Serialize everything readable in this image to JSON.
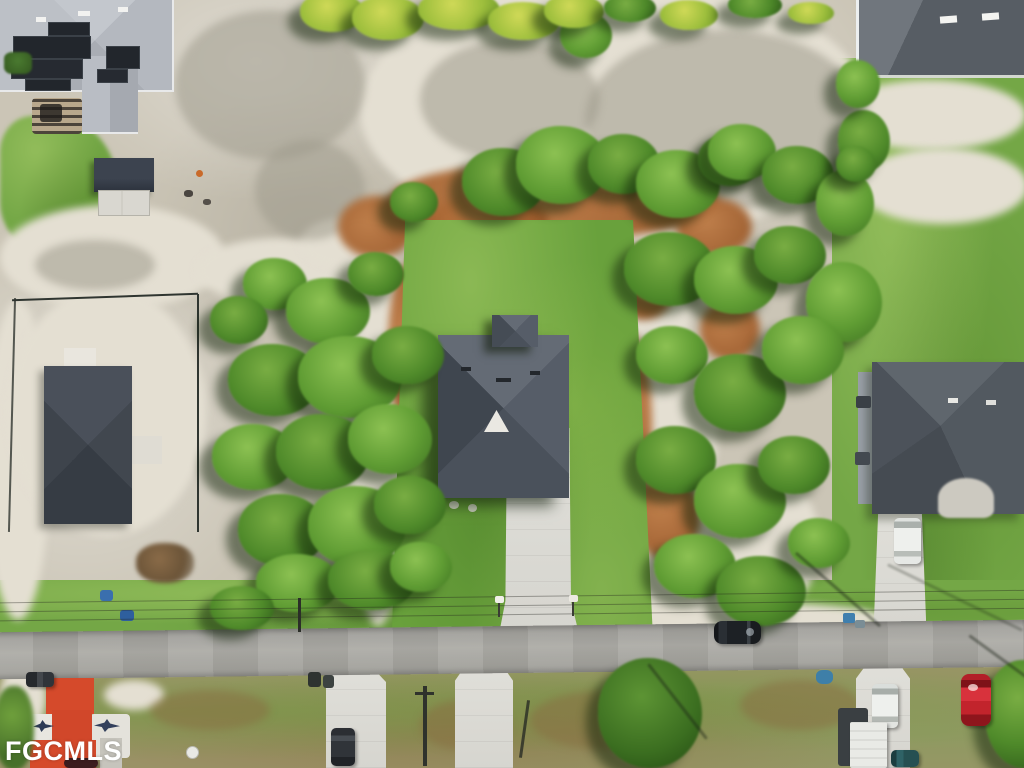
{
  "watermark": {
    "text": "FGCMLS",
    "color": "#ffffff"
  },
  "scene": {
    "description": "Aerial drone photo of a residential neighborhood: new home with gray hip roof and concrete driveway on a green lawn lot, surrounded by trees, white sand, brown mulch, neighboring houses and a street with parked cars",
    "palette": {
      "sand": "#cbc5b6",
      "sand_bright": "#e4dfd2",
      "lawn": "#69a13c",
      "grass": "#74a746",
      "tree": "#4f8a2a",
      "tree_dark": "#234a12",
      "mulch": "#a2602f",
      "road": "#a3a29e",
      "concrete": "#dcdbd5",
      "roof_slate": "#4a515b",
      "roof_light": "#b9bdc3",
      "solar_panel": "#22262c",
      "red_roof": "#d54a2b"
    }
  },
  "objects": {
    "main_house_label": "main house with driveway",
    "cars": [
      {
        "label": "black car parked on road",
        "color": "#1d2125"
      },
      {
        "label": "dark pickup at left road edge",
        "color": "#3b3e42"
      },
      {
        "label": "dark car on lower-left driveway",
        "color": "#303439"
      },
      {
        "label": "white car on right driveway",
        "color": "#eceeea"
      },
      {
        "label": "white car lower right",
        "color": "#eceeea"
      },
      {
        "label": "white trailer lower right",
        "color": "#e9eae6"
      },
      {
        "label": "teal car bottom right",
        "color": "#265052"
      },
      {
        "label": "red car bottom right",
        "color": "#c2242c"
      },
      {
        "label": "maroon car bottom left",
        "color": "#4a1d1d"
      }
    ]
  }
}
